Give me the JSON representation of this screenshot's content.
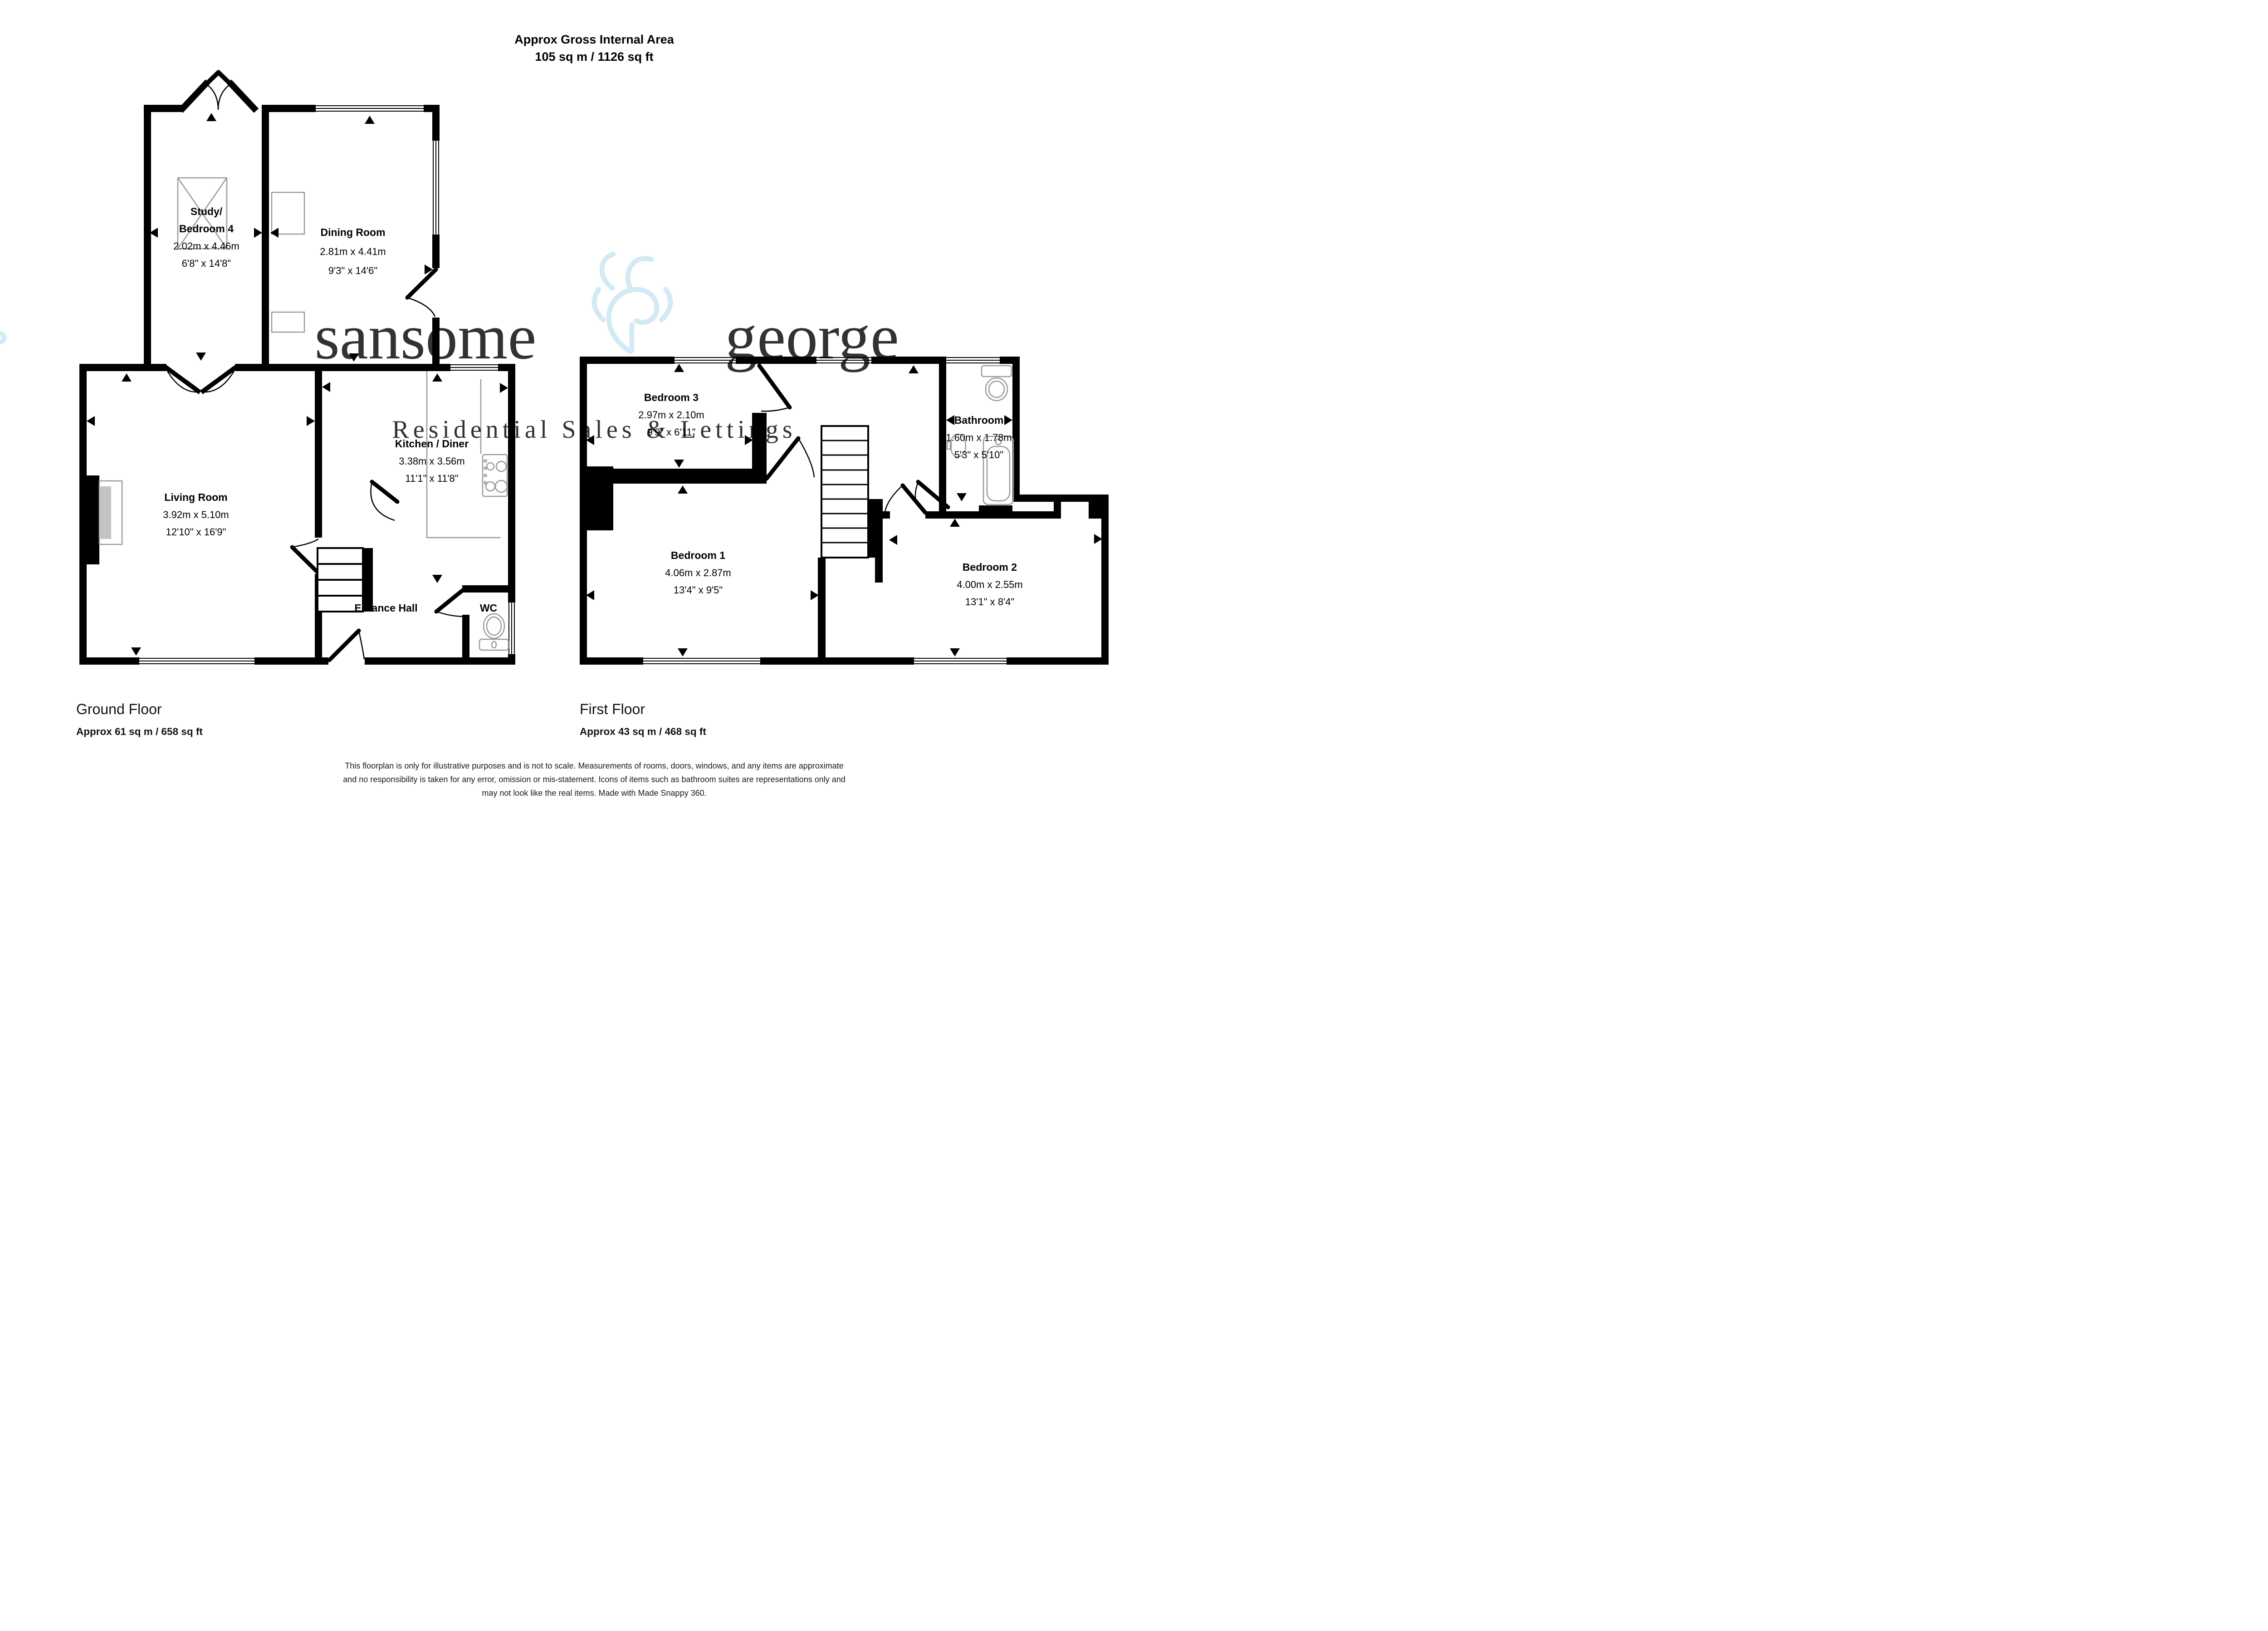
{
  "header": {
    "line1": "Approx Gross Internal Area",
    "line2": "105 sq m / 1126 sq ft"
  },
  "watermark": {
    "brand_left": "sansome",
    "brand_right": "george",
    "tagline": "Residential Sales & Lettings",
    "color": "#c9e6f2"
  },
  "ground": {
    "floor_label": "Ground Floor",
    "floor_area": "Approx 61 sq m / 658 sq ft",
    "rooms": {
      "study": {
        "name1": "Study/",
        "name2": "Bedroom 4",
        "metric": "2.02m x 4.46m",
        "imperial": "6'8\" x 14'8\""
      },
      "dining": {
        "name": "Dining Room",
        "metric": "2.81m x 4.41m",
        "imperial": "9'3\" x 14'6\""
      },
      "living": {
        "name": "Living Room",
        "metric": "3.92m x 5.10m",
        "imperial": "12'10\" x 16'9\""
      },
      "kitchen": {
        "name": "Kitchen / Diner",
        "metric": "3.38m x 3.56m",
        "imperial": "11'1\" x 11'8\""
      },
      "hall": {
        "name": "Enrance Hall"
      },
      "wc": {
        "name": "WC"
      }
    }
  },
  "first": {
    "floor_label": "First Floor",
    "floor_area": "Approx 43 sq m / 468 sq ft",
    "rooms": {
      "bed3": {
        "name": "Bedroom 3",
        "metric": "2.97m x 2.10m",
        "imperial": "9'9\" x 6'11\""
      },
      "bath": {
        "name": "Bathroom",
        "metric": "1.60m x 1.78m",
        "imperial": "5'3\" x 5'10\""
      },
      "bed1": {
        "name": "Bedroom 1",
        "metric": "4.06m x 2.87m",
        "imperial": "13'4\" x 9'5\""
      },
      "bed2": {
        "name": "Bedroom 2",
        "metric": "4.00m x 2.55m",
        "imperial": "13'1\" x 8'4\""
      }
    }
  },
  "footer": {
    "line1": "This floorplan is only for illustrative purposes and is not to scale. Measurements of rooms, doors, windows, and any items are approximate",
    "line2": "and no responsibility is taken for any error, omission or mis-statement. Icons of items such as bathroom suites are representations only and",
    "line3": "may not look like the real items. Made with Made Snappy 360."
  }
}
